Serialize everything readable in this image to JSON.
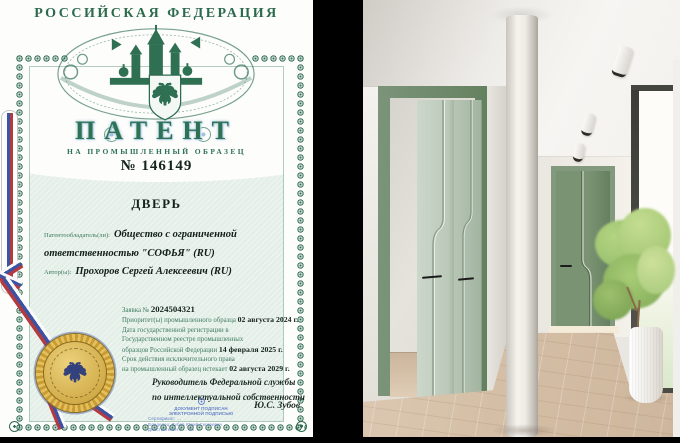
{
  "patent": {
    "country_header": "РОССИЙСКАЯ ФЕДЕРАЦИЯ",
    "doc_type": "ПАТЕНТ",
    "doc_subtype": "НА ПРОМЫШЛЕННЫЙ ОБРАЗЕЦ",
    "number": "№ 146149",
    "title": "ДВЕРЬ",
    "holder_label": "Патентообладатель(ли):",
    "holder_value": "Общество с ограниченной ответственностью \"СОФЬЯ\" (RU)",
    "authors_label": "Автор(ы):",
    "authors_value": "Прохоров Сергей Алексеевич (RU)",
    "application_label": "Заявка №",
    "application_number": "2024504321",
    "priority_label": "Приоритет(ы) промышленного образца",
    "priority_date": "02 августа 2024 г.",
    "registration_line1": "Дата государственной регистрации в",
    "registration_line2": "Государственном реестре промышленных",
    "registration_line3": "образцов Российской Федерации",
    "registration_date": "14 февраля 2025 г.",
    "term_line1": "Срок действия исключительного права",
    "term_line2": "на промышленный образец истекает",
    "term_date": "02 августа 2029 г.",
    "signatory_line1": "Руководитель Федеральной службы",
    "signatory_line2": "по интеллектуальной собственности",
    "signature_name": "Ю.С. Зубов",
    "stamp_line1": "ДОКУМЕНТ ПОДПИСАН",
    "stamp_line2": "ЭЛЕКТРОННОЙ ПОДПИСЬЮ",
    "stamp_line3": "Сертификат: …",
    "stamp_line4": "Владелец: Зубов Юрий Сергеевич",
    "stamp_line5": "Действителен с … по …",
    "colors": {
      "border_green": "#2e6b4f",
      "paper_tint": "#e4efe8",
      "seal_gold": "#d2a63c",
      "ribbon_blue": "#3c53a4",
      "ribbon_red": "#b33a3f",
      "door_green": "#6e8a6c",
      "door_leaf_green": "#c6d2c4"
    }
  }
}
